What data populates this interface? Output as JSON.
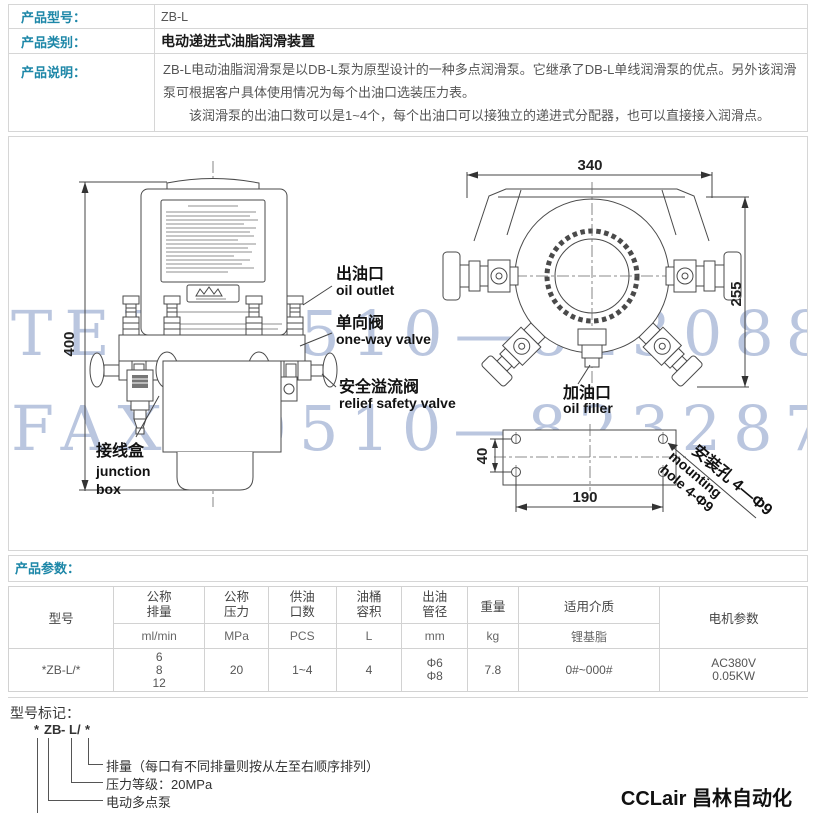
{
  "page": {
    "accent_color": "#1d87a8",
    "watermark_color": "#b7c3de"
  },
  "info": {
    "rows": [
      {
        "label": "产品型号：",
        "value": "ZB-L"
      },
      {
        "label": "产品类别：",
        "value": "电动递进式油脂润滑装置"
      },
      {
        "label": "产品说明：",
        "p1": "ZB-L电动油脂润滑泵是以DB-L泵为原型设计的一种多点润滑泵。它继承了DB-L单线润滑泵的优点。另外该润滑泵可根据客户具体使用情况为每个出油口选装压力表。",
        "p2": "该润滑泵的出油口数可以是1~4个，每个出油口可以接独立的递进式分配器，也可以直接接入润滑点。"
      }
    ]
  },
  "diagram": {
    "watermark_line1": "TEL：0510—82308871",
    "watermark_line2": "FAX：0510—82328771",
    "front_view": {
      "dim_height": "400",
      "oil_outlet_cn": "出油口",
      "oil_outlet_en": "oil outlet",
      "one_way_valve_cn": "单向阀",
      "one_way_valve_en": "one-way valve",
      "relief_valve_cn": "安全溢流阀",
      "relief_valve_en": "relief safety valve",
      "junction_box_cn": "接线盒",
      "junction_box_en1": "junction",
      "junction_box_en2": "box"
    },
    "top_view": {
      "dim_width": "340",
      "dim_depth": "255",
      "oil_filler_cn": "加油口",
      "oil_filler_en": "oil filler"
    },
    "base_view": {
      "dim_hole_pitch_x": "190",
      "dim_hole_pitch_y": "40",
      "mounting_hole_cn": "安装孔 4—Φ9",
      "mounting_hole_en1": "mounting",
      "mounting_hole_en2": "hole 4-Φ9"
    }
  },
  "params": {
    "title": "产品参数：",
    "headers": [
      {
        "l1": "型号",
        "l2": ""
      },
      {
        "l1": "公称",
        "l2": "排量"
      },
      {
        "l1": "公称",
        "l2": "压力"
      },
      {
        "l1": "供油",
        "l2": "口数"
      },
      {
        "l1": "油桶",
        "l2": "容积"
      },
      {
        "l1": "出油",
        "l2": "管径"
      },
      {
        "l1": "重量",
        "l2": ""
      },
      {
        "l1": "适用介质",
        "l2": ""
      },
      {
        "l1": "电机参数",
        "l2": ""
      }
    ],
    "units": {
      "displacement": "ml/min",
      "pressure": "MPa",
      "outlets": "PCS",
      "volume": "L",
      "pipe": "mm",
      "weight": "kg",
      "medium": "锂基脂"
    },
    "row": {
      "model": "*ZB-L/*",
      "displacement": [
        "6",
        "8",
        "12"
      ],
      "pressure": "20",
      "outlets": "1~4",
      "volume": "4",
      "pipe": [
        "Φ6",
        "Φ8"
      ],
      "weight": "7.8",
      "medium": "0#~000#",
      "motor": [
        "AC380V",
        "0.05KW"
      ]
    }
  },
  "marking": {
    "title": "型号标记：",
    "code": {
      "star1": "*",
      "zb": "ZB",
      "dash": "-",
      "l": "L",
      "slash": "/",
      "star2": "*"
    },
    "items": [
      "排量（每口有不同排量则按从左至右顺序排列）",
      "压力等级：20MPa",
      "电动多点泵",
      "出油口数（当只有一口时不填写）"
    ]
  },
  "brand": "CCLair 昌林自动化"
}
